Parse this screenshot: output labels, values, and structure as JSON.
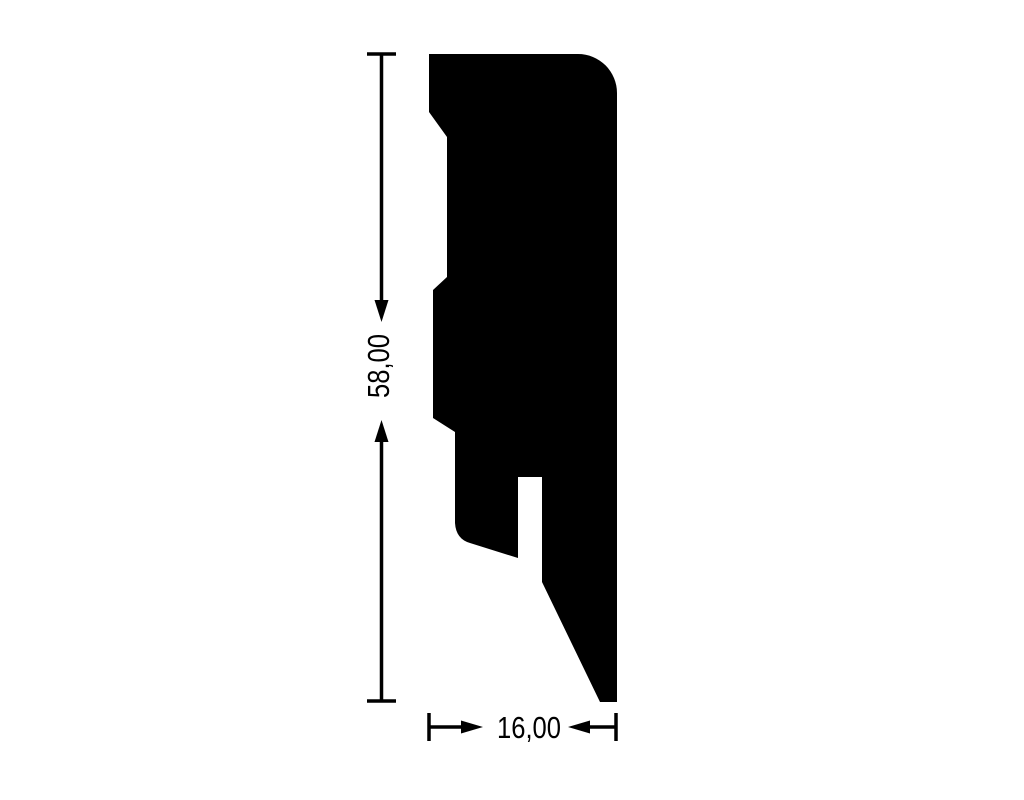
{
  "drawing": {
    "type": "profile-cross-section-technical-drawing",
    "ink_color": "#000000",
    "background_color": "#ffffff",
    "profile_outline": [
      [
        "M",
        429,
        54
      ],
      [
        "L",
        578,
        54
      ],
      [
        "A",
        39,
        39,
        0,
        0,
        1,
        617,
        93
      ],
      [
        "L",
        617,
        702
      ],
      [
        "L",
        600,
        702
      ],
      [
        "L",
        542,
        582
      ],
      [
        "L",
        542,
        477
      ],
      [
        "L",
        518,
        477
      ],
      [
        "L",
        518,
        558
      ],
      [
        "L",
        470,
        543
      ],
      [
        "Q",
        456,
        539,
        455,
        523
      ],
      [
        "L",
        455,
        432
      ],
      [
        "L",
        433,
        418
      ],
      [
        "L",
        433,
        290
      ],
      [
        "L",
        447,
        277
      ],
      [
        "L",
        447,
        137
      ],
      [
        "L",
        429,
        112
      ],
      [
        "Z"
      ]
    ],
    "dimensions": {
      "height": {
        "label": "58,00"
      },
      "width": {
        "label": "16,00"
      }
    }
  }
}
